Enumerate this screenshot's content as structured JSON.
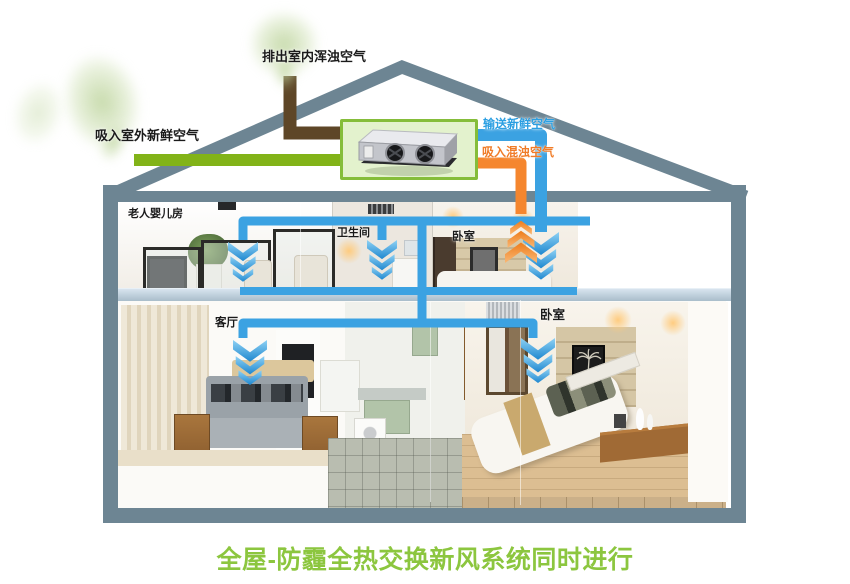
{
  "title": {
    "text": "全屋-防霾全热交换新风系统同时进行"
  },
  "flow_labels": {
    "exhaust_out": "排出室内浑浊空气",
    "fresh_in": "吸入室外新鲜空气",
    "supply_fresh": "输送新鲜空气",
    "return_stale": "吸入混浊空气"
  },
  "rooms": [
    {
      "id": "elder-baby-room",
      "name": "老人婴儿房"
    },
    {
      "id": "bathroom",
      "name": "卫生间"
    },
    {
      "id": "bedroom-upper",
      "name": "卧室"
    },
    {
      "id": "living-room",
      "name": "客厅"
    },
    {
      "id": "bedroom-lower",
      "name": "卧室"
    }
  ],
  "icons": {
    "hrv_unit": "heat-recovery-ventilator",
    "arrows_supply": "blue-down-chevrons",
    "arrow_return": "orange-up-chevrons"
  },
  "colors": {
    "title_green": "#8cc63f",
    "pipe_fresh_green": "#82b318",
    "pipe_exhaust_brown": "#5e4627",
    "pipe_supply_blue": "#3ba2e2",
    "pipe_return_orange": "#f5862e",
    "frame_gray": "#6d8593",
    "unit_box_fill": "#e3f2cd",
    "unit_box_border": "#85bd3a",
    "label_blue": "#2b9fe2",
    "label_orange": "#f07c28",
    "label_black": "#1a1a1a"
  }
}
